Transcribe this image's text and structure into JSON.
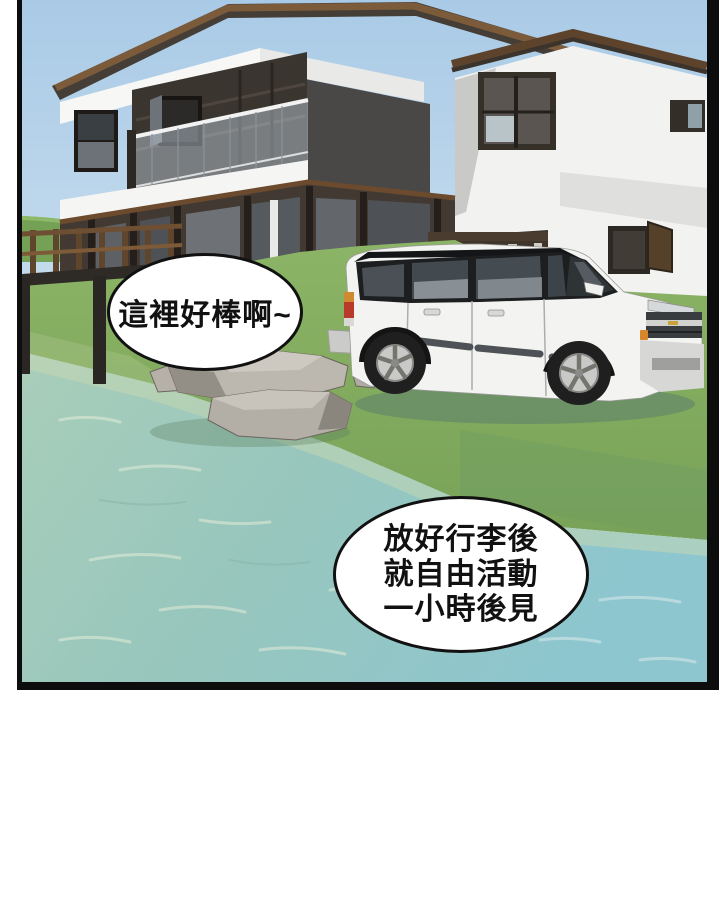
{
  "bubbles": {
    "bubble1": {
      "text": "這裡好棒啊~"
    },
    "bubble2": {
      "line1": "放好行李後",
      "line2": "就自由活動",
      "line3": "一小時後見"
    }
  },
  "colors": {
    "panel_border": "#0d0d0d",
    "sky_top": "#a9cae6",
    "sky_bottom": "#dcebf5",
    "roof_brown": "#7b5b3a",
    "roof_dark": "#453e37",
    "house_white": "#f4f4f2",
    "wood_dark": "#423a32",
    "grass_green": "#84ad5f",
    "water_teal": "#9bc9c0",
    "rock_gray": "#bcb7af",
    "suv_body": "#f3f3f1",
    "taillight_red": "#b93a2a",
    "marker_amber": "#d8862c",
    "bubble_fill": "#ffffff",
    "bubble_stroke": "#111111"
  }
}
